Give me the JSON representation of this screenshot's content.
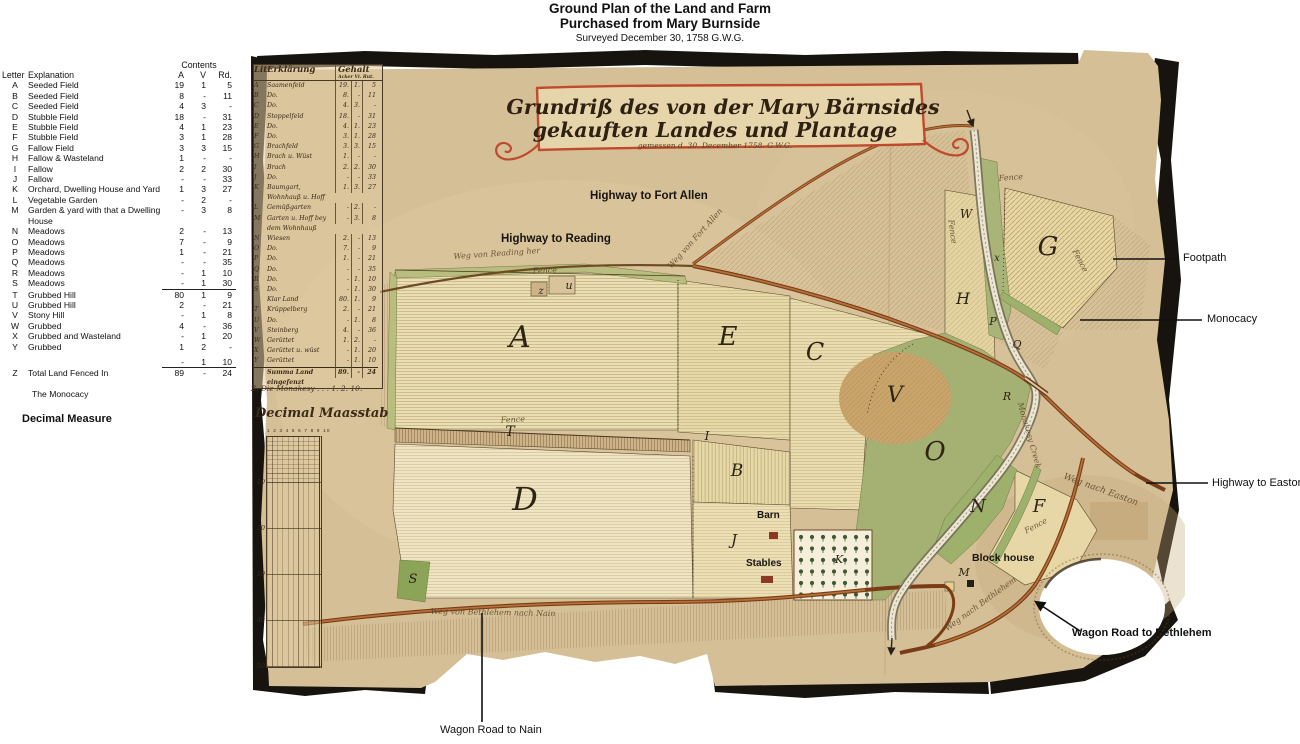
{
  "page": {
    "title1": "Ground Plan of the Land and Farm",
    "title2": "Purchased from Mary Burnside",
    "title3": "Surveyed December 30, 1758   G.W.G."
  },
  "colors": {
    "parchment": "#d5bf97",
    "field_cream": "#eadfb2",
    "meadow_green": "#a4b173",
    "road_brown": "#7a3c16",
    "cartouche_red": "#bf4a2c",
    "ink": "#2e2415",
    "torn_edge_black": "#17130e"
  },
  "legend": {
    "contents_header": "Contents",
    "col_letter": "Letter",
    "col_explanation": "Explanation",
    "col_a": "A",
    "col_v": "V",
    "col_rd": "Rd.",
    "rows": [
      {
        "letter": "A",
        "explanation": "Seeded Field",
        "a": "19",
        "v": "1",
        "rd": "5"
      },
      {
        "letter": "B",
        "explanation": "Seeded Field",
        "a": "8",
        "v": "-",
        "rd": "11"
      },
      {
        "letter": "C",
        "explanation": "Seeded Field",
        "a": "4",
        "v": "3",
        "rd": "-"
      },
      {
        "letter": "D",
        "explanation": "Stubble Field",
        "a": "18",
        "v": "-",
        "rd": "31"
      },
      {
        "letter": "E",
        "explanation": "Stubble Field",
        "a": "4",
        "v": "1",
        "rd": "23"
      },
      {
        "letter": "F",
        "explanation": "Stubble Field",
        "a": "3",
        "v": "1",
        "rd": "28"
      },
      {
        "letter": "G",
        "explanation": "Fallow Field",
        "a": "3",
        "v": "3",
        "rd": "15"
      },
      {
        "letter": "H",
        "explanation": "Fallow & Wasteland",
        "a": "1",
        "v": "-",
        "rd": "-"
      },
      {
        "letter": "I",
        "explanation": "Fallow",
        "a": "2",
        "v": "2",
        "rd": "30"
      },
      {
        "letter": "J",
        "explanation": "Fallow",
        "a": "-",
        "v": "-",
        "rd": "33"
      },
      {
        "letter": "K",
        "explanation": "Orchard, Dwelling House and Yard",
        "a": "1",
        "v": "3",
        "rd": "27"
      },
      {
        "letter": "L",
        "explanation": "Vegetable Garden",
        "a": "-",
        "v": "2",
        "rd": "-"
      },
      {
        "letter": "M",
        "explanation": "Garden & yard with that a Dwelling House",
        "a": "-",
        "v": "3",
        "rd": "8"
      },
      {
        "letter": "N",
        "explanation": "Meadows",
        "a": "2",
        "v": "-",
        "rd": "13"
      },
      {
        "letter": "O",
        "explanation": "Meadows",
        "a": "7",
        "v": "-",
        "rd": "9"
      },
      {
        "letter": "P",
        "explanation": "Meadows",
        "a": "1",
        "v": "-",
        "rd": "21"
      },
      {
        "letter": "Q",
        "explanation": "Meadows",
        "a": "-",
        "v": "-",
        "rd": "35"
      },
      {
        "letter": "R",
        "explanation": "Meadows",
        "a": "-",
        "v": "1",
        "rd": "10"
      },
      {
        "letter": "S",
        "explanation": "Meadows",
        "a": "-",
        "v": "1",
        "rd": "30",
        "u": true
      },
      {
        "letter": "T",
        "explanation": "Grubbed Hill",
        "a": "80",
        "v": "1",
        "rd": "9"
      },
      {
        "letter": "U",
        "explanation": "Grubbed Hill",
        "a": "2",
        "v": "-",
        "rd": "21"
      },
      {
        "letter": "V",
        "explanation": "Stony Hill",
        "a": "-",
        "v": "1",
        "rd": "8"
      },
      {
        "letter": "W",
        "explanation": "Grubbed",
        "a": "4",
        "v": "-",
        "rd": "36"
      },
      {
        "letter": "X",
        "explanation": "Grubbed and Wasteland",
        "a": "-",
        "v": "1",
        "rd": "20"
      },
      {
        "letter": "Y",
        "explanation": "Grubbed",
        "a": "1",
        "v": "2",
        "rd": "-"
      },
      {
        "gap": true
      },
      {
        "letter": "",
        "explanation": "",
        "a": "-",
        "v": "1",
        "rd": "10",
        "u": true
      },
      {
        "letter": "Z",
        "explanation": "Total Land Fenced In",
        "a": "89",
        "v": "-",
        "rd": "24"
      }
    ],
    "monocacy_note": "The Monocacy",
    "decimal_heading": "Decimal Measure"
  },
  "map": {
    "cartouche": {
      "line1": "Grundriß des von der Mary Bärnsides",
      "line2": "gekauften Landes und Plantage",
      "line3": "gemessen d. 30. December 1758.        G.W.G."
    },
    "german_table": {
      "header_lit": "Lit.",
      "header_erkl": "Erklärung",
      "header_gehalt": "Gehalt",
      "header_sub": "Acker Vi. Rut.",
      "rows": [
        {
          "letter": "A",
          "text": "Saamenfeld",
          "a": "19.",
          "v": "1.",
          "r": "5"
        },
        {
          "letter": "B",
          "text": "Do.",
          "a": "8.",
          "v": "-",
          "r": "11"
        },
        {
          "letter": "C",
          "text": "Do.",
          "a": "4.",
          "v": "3.",
          "r": "-"
        },
        {
          "letter": "D",
          "text": "Stoppelfeld",
          "a": "18.",
          "v": "-",
          "r": "31"
        },
        {
          "letter": "E",
          "text": "Do.",
          "a": "4.",
          "v": "1.",
          "r": "23"
        },
        {
          "letter": "F",
          "text": "Do.",
          "a": "3.",
          "v": "1.",
          "r": "28"
        },
        {
          "letter": "G",
          "text": "Brachfeld",
          "a": "3.",
          "v": "3.",
          "r": "15"
        },
        {
          "letter": "H",
          "text": "Brach u. Wüst",
          "a": "1.",
          "v": "-",
          "r": "-"
        },
        {
          "letter": "I",
          "text": "Brach",
          "a": "2.",
          "v": "2.",
          "r": "30"
        },
        {
          "letter": "J",
          "text": "Do.",
          "a": "-",
          "v": "-",
          "r": "33"
        },
        {
          "letter": "K",
          "text": "Baumgart, Wohnhauß u. Hoff",
          "a": "1.",
          "v": "3.",
          "r": "27"
        },
        {
          "letter": "L",
          "text": "Gemüßgarten",
          "a": "-",
          "v": "2.",
          "r": "-"
        },
        {
          "letter": "M",
          "text": "Garten u. Hoff bey dem Wohnhauß",
          "a": "-",
          "v": "3.",
          "r": "8"
        },
        {
          "letter": "N",
          "text": "Wiesen",
          "a": "2.",
          "v": "-",
          "r": "13"
        },
        {
          "letter": "O",
          "text": "Do.",
          "a": "7.",
          "v": "-",
          "r": "9"
        },
        {
          "letter": "P",
          "text": "Do.",
          "a": "1.",
          "v": "-",
          "r": "21"
        },
        {
          "letter": "Q",
          "text": "Do.",
          "a": "-",
          "v": "-",
          "r": "35"
        },
        {
          "letter": "R",
          "text": "Do.",
          "a": "-",
          "v": "1.",
          "r": "10"
        },
        {
          "letter": "S",
          "text": "Do.",
          "a": "-",
          "v": "1.",
          "r": "30"
        },
        {
          "letter": "",
          "text": "Klar Land",
          "a": "80.",
          "v": "1.",
          "r": "9"
        },
        {
          "letter": "T",
          "text": "Krüppelberg",
          "a": "2.",
          "v": "-",
          "r": "21"
        },
        {
          "letter": "U",
          "text": "Do.",
          "a": "-",
          "v": "1.",
          "r": "8"
        },
        {
          "letter": "V",
          "text": "Steinberg",
          "a": "4.",
          "v": "-",
          "r": "36"
        },
        {
          "letter": "W",
          "text": "Gerüttet",
          "a": "1.",
          "v": "2.",
          "r": "-"
        },
        {
          "letter": "X",
          "text": "Gerüttet u. wüst",
          "a": "-",
          "v": "1.",
          "r": "20"
        },
        {
          "letter": "Y",
          "text": "Gerüttet",
          "a": "-",
          "v": "1.",
          "r": "10"
        },
        {
          "letter": "",
          "text": "Summa Land eingefenzt",
          "a": "89.",
          "v": "-",
          "r": "24",
          "sum": true
        }
      ],
      "footer": "Z. Die Monakesy  .  .  .   1. 2. 10."
    },
    "scale": {
      "title": "Decimal Maasstab",
      "top_ticks": "1 2 3 4 5 6 7 8 9 10",
      "ticks": [
        "10",
        "20",
        "30",
        "40",
        "50"
      ]
    },
    "typed_labels": [
      {
        "t": "Highway to Fort Allen",
        "x": 345,
        "y": 150,
        "fs": 11.5
      },
      {
        "t": "Highway to Reading",
        "x": 256,
        "y": 193,
        "fs": 11.5
      },
      {
        "t": "Barn",
        "x": 512,
        "y": 470,
        "fs": 10
      },
      {
        "t": "Stables",
        "x": 501,
        "y": 518,
        "fs": 10
      },
      {
        "t": "Block house",
        "x": 727,
        "y": 512,
        "fs": 10.5
      }
    ],
    "script_labels": [
      {
        "t": "Fence",
        "x": 300,
        "y": 233,
        "r": -2,
        "fs": 8
      },
      {
        "t": "Fence",
        "x": 268,
        "y": 382,
        "r": -3,
        "fs": 8
      },
      {
        "t": "Fence",
        "x": 766,
        "y": 140,
        "r": -4,
        "fs": 8
      },
      {
        "t": "Fence",
        "x": 833,
        "y": 222,
        "r": 62,
        "fs": 8
      },
      {
        "t": "Fence",
        "x": 705,
        "y": 192,
        "r": 82,
        "fs": 8
      },
      {
        "t": "Fence",
        "x": 792,
        "y": 488,
        "r": -28,
        "fs": 8
      },
      {
        "t": "Weg von Reading her",
        "x": 252,
        "y": 216,
        "r": -4,
        "fs": 8
      },
      {
        "t": "Weg von Fort Allen",
        "x": 452,
        "y": 200,
        "r": -48,
        "fs": 8
      },
      {
        "t": "Weg nach Easton",
        "x": 855,
        "y": 452,
        "r": 20,
        "fs": 9
      },
      {
        "t": "Weg nach Bethlehem",
        "x": 737,
        "y": 566,
        "r": -36,
        "fs": 8
      },
      {
        "t": "Weg von Bethlehem nach Nain",
        "x": 248,
        "y": 575,
        "r": 1,
        "fs": 8
      },
      {
        "t": "Monakesy Creek",
        "x": 782,
        "y": 396,
        "r": 74,
        "fs": 8
      }
    ],
    "field_letters": [
      {
        "t": "A",
        "x": 275,
        "y": 307,
        "s": 30
      },
      {
        "t": "B",
        "x": 492,
        "y": 436,
        "s": 17
      },
      {
        "t": "C",
        "x": 570,
        "y": 320,
        "s": 24
      },
      {
        "t": "D",
        "x": 280,
        "y": 470,
        "s": 32
      },
      {
        "t": "E",
        "x": 483,
        "y": 305,
        "s": 26
      },
      {
        "t": "F",
        "x": 794,
        "y": 472,
        "s": 18
      },
      {
        "t": "G",
        "x": 803,
        "y": 215,
        "s": 26
      },
      {
        "t": "H",
        "x": 718,
        "y": 264,
        "s": 16
      },
      {
        "t": "I",
        "x": 462,
        "y": 400,
        "s": 12
      },
      {
        "t": "J",
        "x": 489,
        "y": 505,
        "s": 15
      },
      {
        "t": "K",
        "x": 594,
        "y": 523,
        "s": 11
      },
      {
        "t": "M",
        "x": 719,
        "y": 536,
        "s": 11
      },
      {
        "t": "N",
        "x": 733,
        "y": 472,
        "s": 18
      },
      {
        "t": "O",
        "x": 690,
        "y": 420,
        "s": 26
      },
      {
        "t": "P",
        "x": 748,
        "y": 285,
        "s": 11
      },
      {
        "t": "Q",
        "x": 772,
        "y": 308,
        "s": 11
      },
      {
        "t": "R",
        "x": 762,
        "y": 360,
        "s": 11
      },
      {
        "t": "S",
        "x": 168,
        "y": 543,
        "s": 13
      },
      {
        "t": "T",
        "x": 265,
        "y": 396,
        "s": 14
      },
      {
        "t": "V",
        "x": 650,
        "y": 362,
        "s": 22
      },
      {
        "t": "W",
        "x": 721,
        "y": 178,
        "s": 12
      },
      {
        "t": "x",
        "x": 752,
        "y": 221,
        "s": 10
      },
      {
        "t": "z",
        "x": 296,
        "y": 254,
        "s": 10
      },
      {
        "t": "u",
        "x": 324,
        "y": 249,
        "s": 11
      }
    ]
  },
  "callouts": [
    {
      "label": "Footpath"
    },
    {
      "label": "Monocacy"
    },
    {
      "label": "Highway to Easton"
    },
    {
      "label": "Wagon Road to Bethlehem"
    },
    {
      "label": "Wagon Road to Nain"
    }
  ]
}
